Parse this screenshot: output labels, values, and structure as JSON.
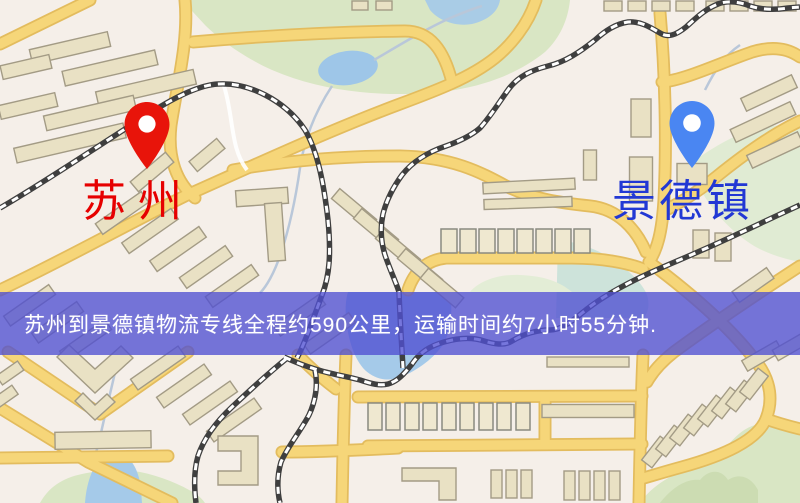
{
  "map": {
    "origin": {
      "name": "苏州",
      "marker": "red-pin",
      "marker_color": "#e8140a",
      "label_color": "#e60000"
    },
    "destination": {
      "name": "景德镇",
      "marker": "blue-pin",
      "marker_color": "#4a86f2",
      "label_color": "#2238d4"
    },
    "banner": {
      "text": "苏州到景德镇物流专线全程约590公里，运输时间约7小时55分钟.",
      "background": "rgba(80,80,210,0.78)",
      "text_color": "#ffffff"
    },
    "route_info": {
      "origin": "苏州",
      "destination": "景德镇",
      "distance_text": "约590公里",
      "duration_text": "约7小时55分钟"
    },
    "legend_colors": {
      "background": "#f5efe9",
      "road_fill": "#f6d679",
      "road_casing": "#e3bc5e",
      "building_fill": "#e9e1c4",
      "building_stroke": "#a39b85",
      "park_green": "#d9e6c4",
      "water_blue": "#a5cae9",
      "railway_dark": "#3f3f3f"
    }
  }
}
